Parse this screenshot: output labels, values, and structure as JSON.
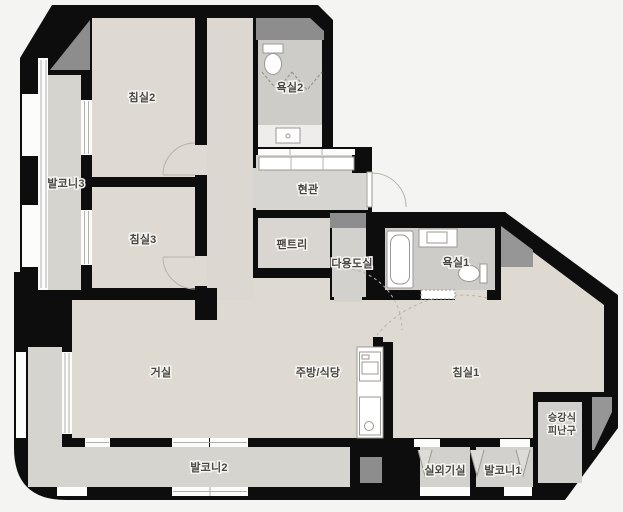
{
  "rooms": {
    "bedroom2": "침실2",
    "bathroom2": "욕실2",
    "balcony3": "발코니3",
    "bedroom3": "침실3",
    "entrance": "현관",
    "pantry": "팬트리",
    "utility": "다용도실",
    "bathroom1": "욕실1",
    "living": "거실",
    "kitchen": "주방/식당",
    "bedroom1": "침실1",
    "evac_line1": "승강식",
    "evac_line2": "피난구",
    "balcony2": "발코니2",
    "outdoor_unit": "실외기실",
    "balcony1": "발코니1"
  },
  "colors": {
    "background": "#f4f4f3",
    "wall": "#0d0d0d",
    "room_floor": "#ded9d1",
    "service_floor": "#d6d4cf",
    "bath_floor": "#cdccc9",
    "shaft": "#8d8d8d",
    "label_text": "#4a4742"
  }
}
